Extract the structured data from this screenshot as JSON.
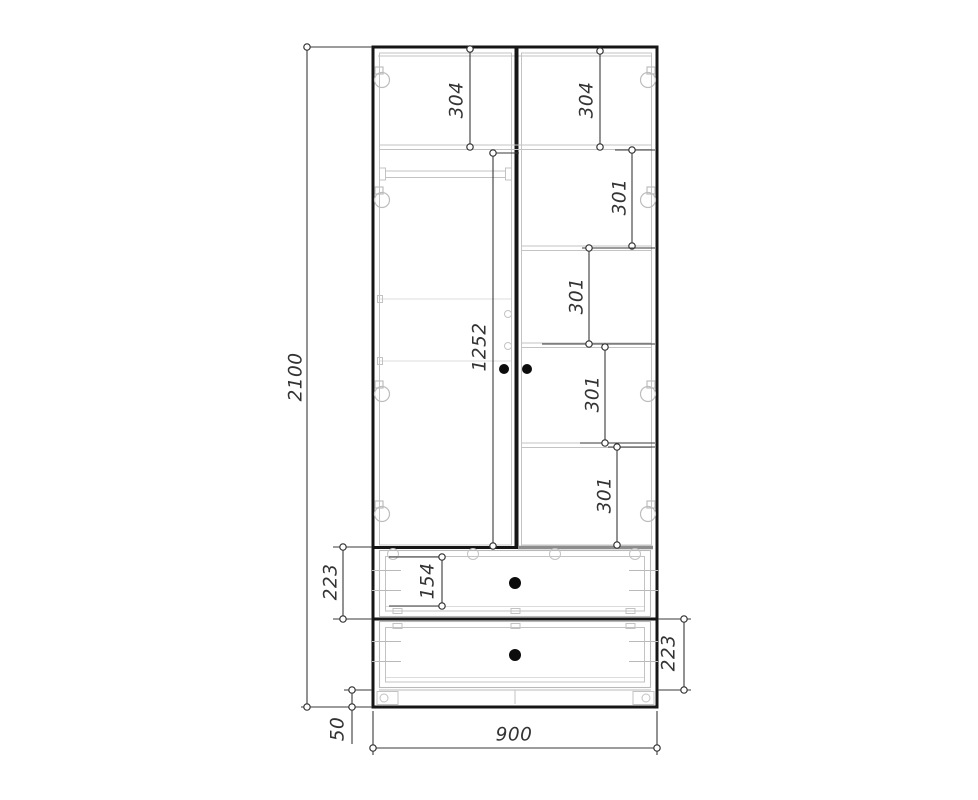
{
  "drawing": {
    "dims": {
      "overall_height": "2100",
      "overall_width": "900",
      "plinth_height": "50",
      "top_section_left": "304",
      "top_section_right": "304",
      "shelf_gap_1": "301",
      "shelf_gap_2": "301",
      "shelf_gap_3": "301",
      "shelf_gap_4": "301",
      "door_height": "1252",
      "drawer_1_section": "223",
      "drawer_1_front": "154",
      "drawer_2_section": "223"
    },
    "colors": {
      "background": "#ffffff",
      "outline_heavy": "#161616",
      "dimension_line": "#3a3a3a",
      "internal_light": "#c3c3c3",
      "section_gray": "#8d8d8d"
    }
  }
}
